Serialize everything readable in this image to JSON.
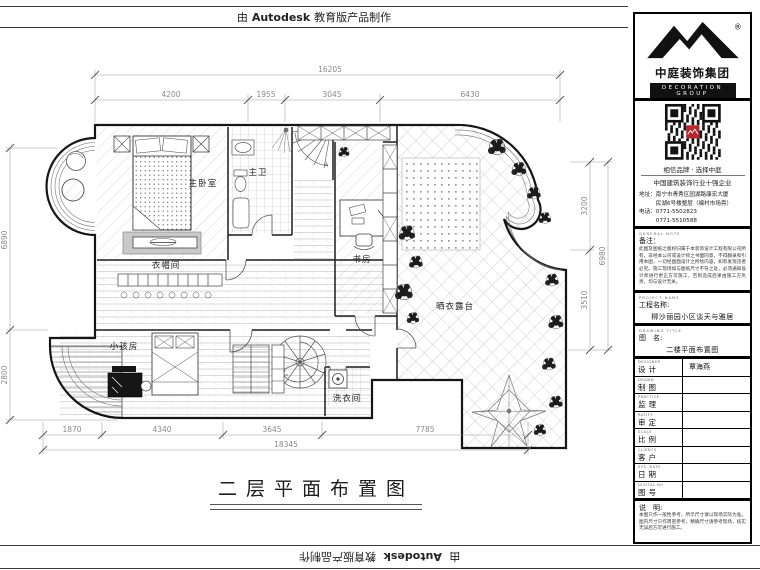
{
  "stamp": {
    "prefix": "由",
    "brand": "Autodesk",
    "suffix": "教育版产品制作"
  },
  "plan": {
    "title": "二层平面布置图",
    "rooms": {
      "master_bedroom": "主卧室",
      "master_bath": "主卫",
      "study": "书房",
      "cloakroom": "衣帽间",
      "kids_room": "小孩房",
      "laundry": "洗衣间",
      "terrace": "晒衣露台"
    },
    "dims": {
      "top_total": "16205",
      "top": [
        "4200",
        "1955",
        "3045",
        "6430"
      ],
      "bottom": [
        "1870",
        "4340",
        "3645",
        "7785"
      ],
      "bottom_total": "18345",
      "left": [
        "6890",
        "2800"
      ],
      "right": [
        "3200",
        "3510"
      ],
      "right_total": "6980"
    }
  },
  "titleblock": {
    "brand": {
      "name": "中庭装饰集团",
      "subtitle": "DECORATION GROUP",
      "registered": "®"
    },
    "slogan1": "相信品牌 · 选择中庭",
    "slogan2": "中国建筑装饰行业十强企业",
    "address_line1": "地址：南宁市青秀区园湖路康宏大厦",
    "address_line2": "　　　民湖6号楼整层（编村市场旁）",
    "phone_line1": "电话：0771-5502823",
    "phone_line2": "　　　0771-5510588",
    "note_en": "GENERAL NOTE",
    "note_label": "备注：",
    "note_text": "此图及图纸之版权归属于本装饰设计工程有限公司所有，非经本公司或设计师之书面同意，不得翻录和引用本图，一切经图面设计之所绘内容，如有发现违者必究。施工现场如与图纸尺寸不符之处，必须通知设计师进行更正方可施工，否则造成后果由施工方负责，均与设计无关。",
    "project_en": "PROJECT NAME",
    "project_label": "工程名称:",
    "project_value": "柳沙丽园小区谈天与雅居",
    "drawing_en": "DRAWING TITLE",
    "drawing_label": "图　名:",
    "drawing_value": "二楼平面布置图",
    "fields": [
      {
        "en": "DESIGNER",
        "label": "设计",
        "value": "覃海燕"
      },
      {
        "en": "DRAWN",
        "label": "制图",
        "value": ""
      },
      {
        "en": "PRACTICE",
        "label": "监理",
        "value": ""
      },
      {
        "en": "RATIFY",
        "label": "审定",
        "value": ""
      },
      {
        "en": "SCALE",
        "label": "比例",
        "value": ""
      },
      {
        "en": "CLIENTS",
        "label": "客户",
        "value": ""
      },
      {
        "en": "SYS. DATE",
        "label": "日期",
        "value": ""
      },
      {
        "en": "DIGITAL NO",
        "label": "图号",
        "value": ""
      }
    ],
    "remark_label": "说　明:",
    "remark_text": "本图只作一般性参考，所示尺寸请以现场实际为准。图内尺寸只作周密参考，精确尺寸请参考现场，核实无误后方可进行施工。"
  }
}
